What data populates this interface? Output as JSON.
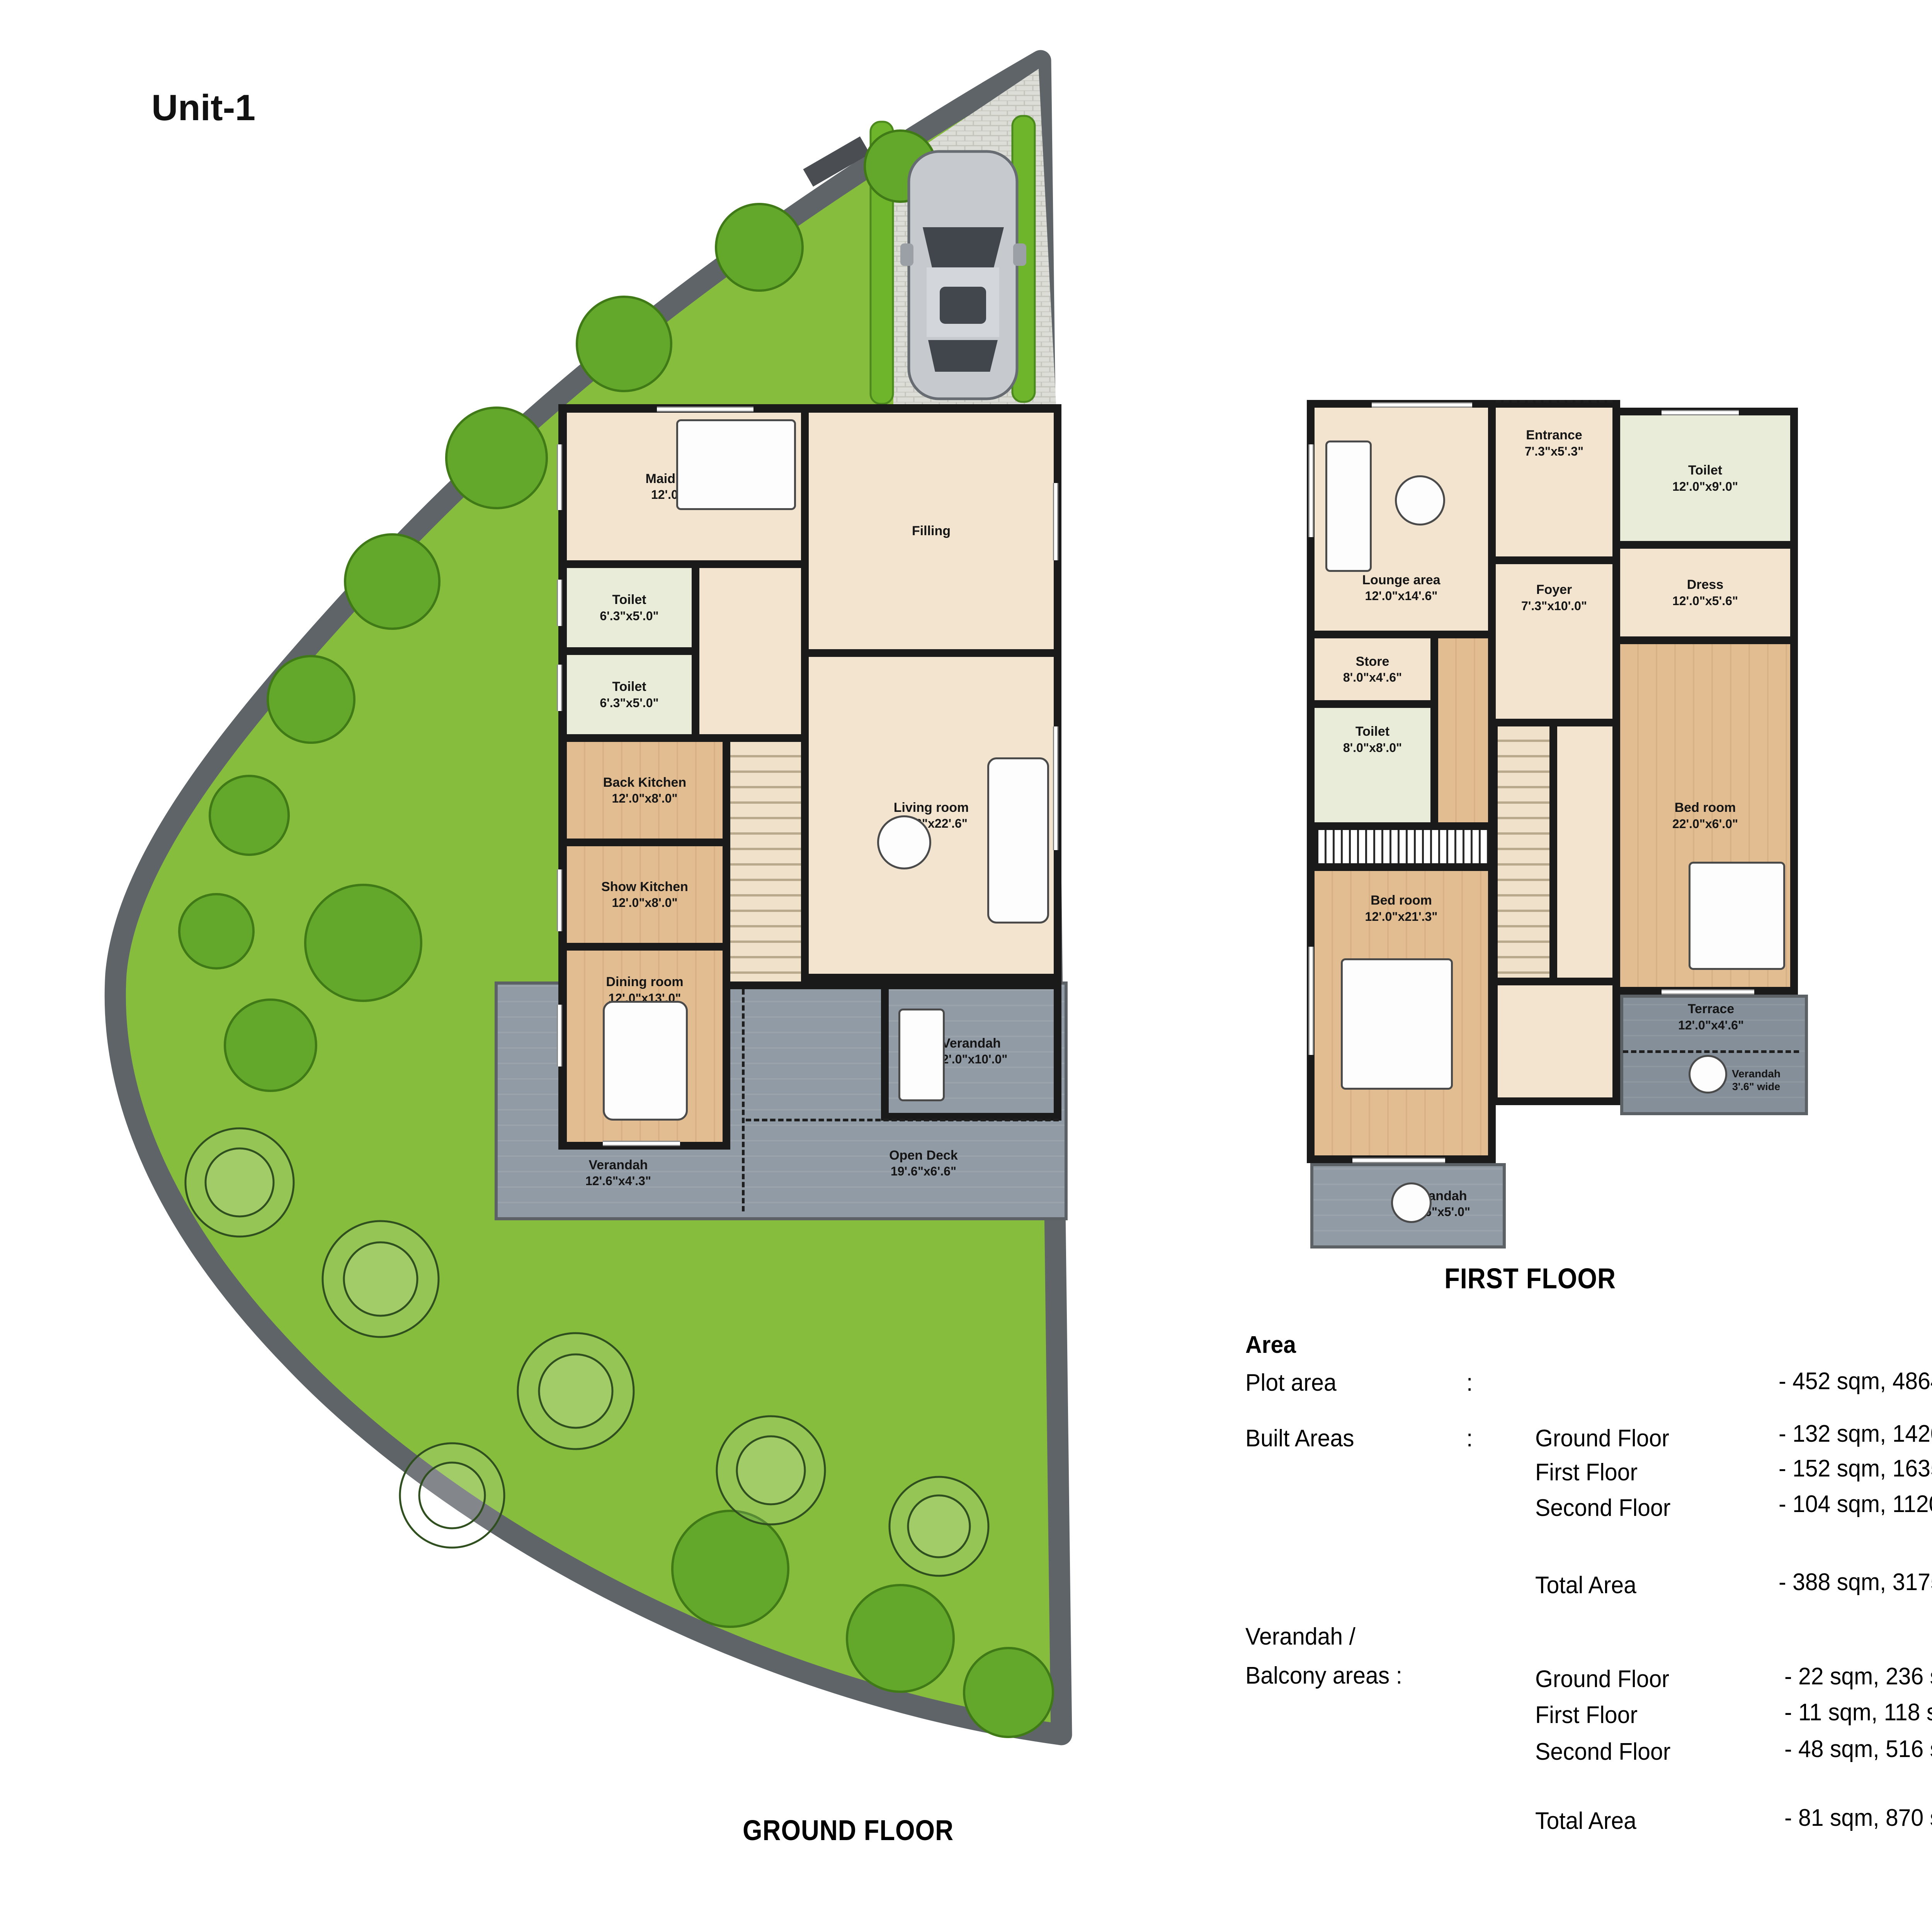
{
  "title": "Unit-1",
  "colors": {
    "lawn": "#87bd3d",
    "plot_border": "#5f6468",
    "wall": "#1a1a1a",
    "floor_cream": "#f2e4cf",
    "floor_wood": "#e0ba8e",
    "toilet_floor": "#e9ecd9",
    "verandah_gray": "#919ba5",
    "terrace_weave": "#b0a28a",
    "pool_teal": "#c9e6e0"
  },
  "ground": {
    "caption": "GROUND FLOOR",
    "maids": {
      "name": "Maid's room",
      "dim": "12'.0\"x9'.3\""
    },
    "filling": {
      "name": "Filling"
    },
    "toilet1": {
      "name": "Toilet",
      "dim": "6'.3\"x5'.0\""
    },
    "toilet2": {
      "name": "Toilet",
      "dim": "6'.3\"x5'.0\""
    },
    "back_kitchen": {
      "name": "Back Kitchen",
      "dim": "12'.0\"x8'.0\""
    },
    "show_kitchen": {
      "name": "Show Kitchen",
      "dim": "12'.0\"x8'.0\""
    },
    "dining": {
      "name": "Dining room",
      "dim": "12'.0\"x13'.0\""
    },
    "living": {
      "name": "Living room",
      "dim": "19'.6\"x22'.6\""
    },
    "verandah_right": {
      "name": "Verandah",
      "dim": "12'.0\"x10'.0\""
    },
    "verandah_bottom": {
      "name": "Verandah",
      "dim": "12'.6\"x4'.3\""
    },
    "open_deck": {
      "name": "Open Deck",
      "dim": "19'.6\"x6'.6\""
    }
  },
  "first": {
    "caption": "FIRST FLOOR",
    "entrance": {
      "name": "Entrance",
      "dim": "7'.3\"x5'.3\""
    },
    "toilet_top": {
      "name": "Toilet",
      "dim": "12'.0\"x9'.0\""
    },
    "lounge": {
      "name": "Lounge area",
      "dim": "12'.0\"x14'.6\""
    },
    "foyer": {
      "name": "Foyer",
      "dim": "7'.3\"x10'.0\""
    },
    "dress": {
      "name": "Dress",
      "dim": "12'.0\"x5'.6\""
    },
    "store": {
      "name": "Store",
      "dim": "8'.0\"x4'.6\""
    },
    "toilet_mid": {
      "name": "Toilet",
      "dim": "8'.0\"x8'.0\""
    },
    "bed_right": {
      "name": "Bed room",
      "dim": "22'.0\"x6'.0\""
    },
    "bed_left": {
      "name": "Bed room",
      "dim": "12'.0\"x21'.3\""
    },
    "terrace": {
      "name": "Terrace",
      "dim": "12'.0\"x4'.6\""
    },
    "verandah_side": {
      "name": "Verandah",
      "dim": "3'.6\" wide"
    },
    "verandah_bottom": {
      "name": "Verandah",
      "dim": "12'.6\"x5'.0\""
    }
  },
  "second": {
    "caption": "SECOND FLOOR",
    "dress": {
      "name": "Dress",
      "dim": "7'.6\"x7'.0\""
    },
    "bed_top": {
      "name": "Bed room",
      "dim": "12'.0\"x15'.8\""
    },
    "toilet1": {
      "name": "Toilet",
      "dim": "8'.0\"x7'.0\""
    },
    "toilet2": {
      "name": "Toilet",
      "dim": "8'.0\"x8'.0\""
    },
    "terrace": {
      "name": "Terrace",
      "dim": "12'.0\"x39'.3\""
    },
    "sauna": {
      "name": "Sauna",
      "dim": "6'.0\"x5'.0\""
    },
    "bed_bottom": {
      "name": "Bed room",
      "dim": "12'.0\"x21'.3\""
    },
    "study": {
      "name": "Study room",
      "dim": "7'.3\"x8'.6\""
    },
    "verandah_bottom": {
      "name": "Verandah",
      "dim": "12'.6\"x5'.0\""
    }
  },
  "table": {
    "heading": "Area",
    "plot": {
      "label": "Plot area",
      "colon": ":",
      "value": "- 452 sqm, 4864 sft"
    },
    "built": {
      "label": "Built Areas",
      "colon": ":",
      "rows": [
        {
          "sub": "Ground Floor",
          "value": "- 132 sqm, 1420 sft"
        },
        {
          "sub": "First Floor",
          "value": "- 152 sqm, 1635 sft"
        },
        {
          "sub": "Second Floor",
          "value": "- 104 sqm, 1120 sft"
        }
      ],
      "total": {
        "sub": "Total Area",
        "value": "- 388 sqm, 3175 sft"
      }
    },
    "verandah": {
      "label_line1": "Verandah /",
      "label_line2": "Balcony areas :",
      "rows": [
        {
          "sub": "Ground Floor",
          "value": "- 22 sqm,  236 sft"
        },
        {
          "sub": "First Floor",
          "value": "- 11 sqm,  118 sft"
        },
        {
          "sub": "Second Floor",
          "value": "- 48 sqm,  516 sft"
        }
      ],
      "total": {
        "sub": "Total Area",
        "value": "- 81 sqm,  870 sft"
      }
    }
  }
}
